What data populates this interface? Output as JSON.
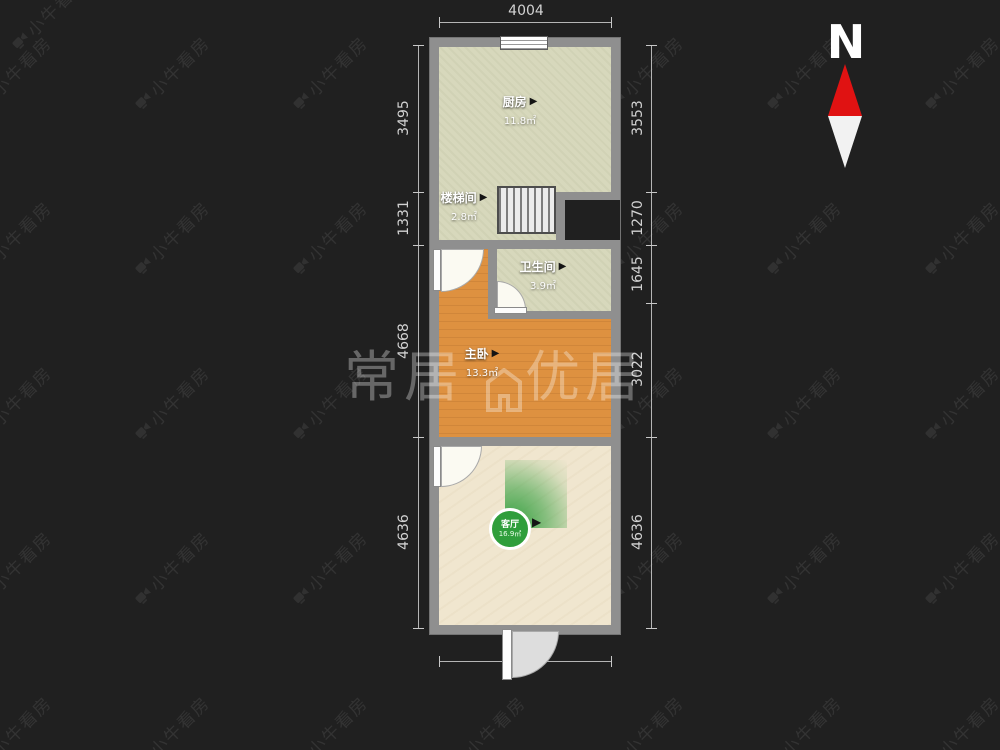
{
  "watermark": {
    "tile_text": "小牛看房",
    "icon": "video-camera-icon"
  },
  "brand": {
    "left": "常居",
    "right": "优居"
  },
  "compass": {
    "label": "N"
  },
  "icons": {
    "room_arrow": "▶"
  },
  "dimensions": {
    "top": "4004",
    "bottom": "4004",
    "left": [
      "3495",
      "1331",
      "4668",
      "4636"
    ],
    "right": [
      "3553",
      "1270",
      "1645",
      "3022",
      "4636"
    ]
  },
  "rooms": {
    "kitchen": {
      "name": "厨房",
      "area": "11.8㎡"
    },
    "stairwell": {
      "name": "楼梯间",
      "area": "2.8㎡"
    },
    "bathroom": {
      "name": "卫生间",
      "area": "3.9㎡"
    },
    "bedroom": {
      "name": "主卧",
      "area": "13.3㎡"
    },
    "living": {
      "name": "客厅",
      "area": "16.9㎡"
    }
  },
  "colors": {
    "background": "#202020",
    "wall": "#8f8f8f",
    "kitchen_floor": "#d7d8bc",
    "wood_floor": "#de9140",
    "living_floor": "#f0e6cf",
    "accent_green": "#2f9e3c",
    "north_red": "#e01212"
  }
}
